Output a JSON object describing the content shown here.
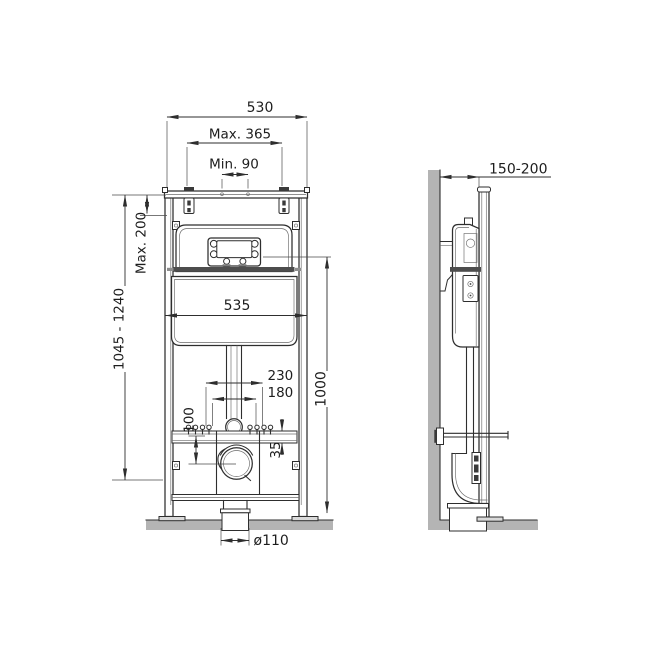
{
  "dims": {
    "front": {
      "overall_width": "530",
      "hanger_spacing_max": "Max. 365",
      "hanger_gap_min": "Min. 90",
      "top_adjust_max": "Max. 200",
      "frame_height_range": "1045 - 1240",
      "cistern_width": "535",
      "studs_outer": "230",
      "studs_inner": "180",
      "rail_to_outlet": "100",
      "rail_profile_height": "35",
      "panel_center_height": "1000",
      "outlet_diameter": "ø110"
    },
    "side": {
      "wall_clearance": "150-200"
    }
  },
  "style": {
    "wall_fill": "#b4b4b4",
    "floor_fill": "#b4b4b4",
    "shelf_fill": "#4d4d4d",
    "line_color": "#2e2e2e"
  }
}
